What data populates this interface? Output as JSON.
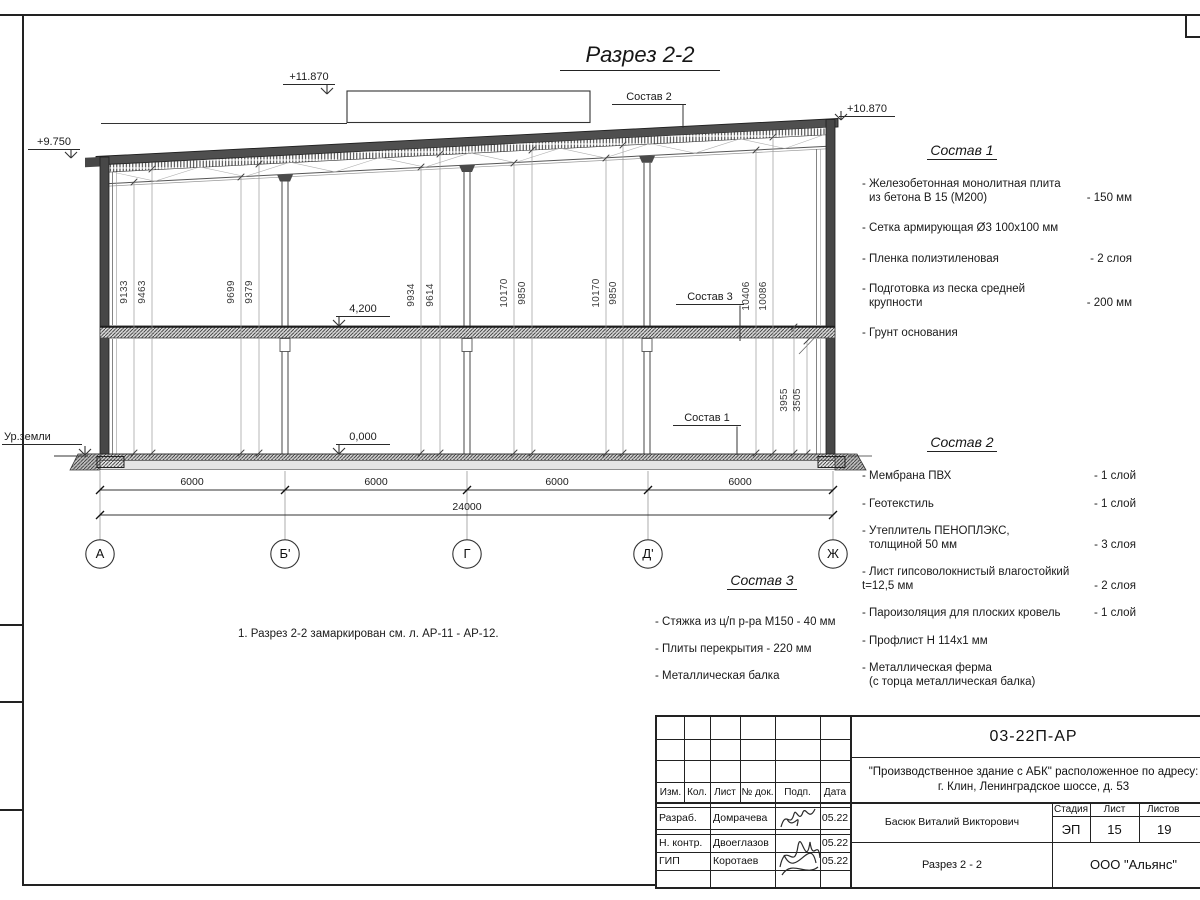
{
  "sheet": {
    "title": "Разрез 2-2",
    "note": "1. Разрез 2-2 замаркирован см. л. АР-11 - АР-12."
  },
  "elevations": {
    "roof_high": "+11.870",
    "roof_left": "+9.750",
    "roof_right": "+10.870",
    "floor2": "4,200",
    "floor1": "0,000",
    "ground": "Ур.земли"
  },
  "callouts": {
    "c1": "Состав 1",
    "c2": "Состав 2",
    "c3": "Состав 3"
  },
  "axes": [
    "А",
    "Б'",
    "Г",
    "Д'",
    "Ж"
  ],
  "dims": {
    "spans": [
      "6000",
      "6000",
      "6000",
      "6000"
    ],
    "total": "24000",
    "vertical": [
      "9133",
      "9463",
      "9699",
      "9379",
      "9934",
      "9614",
      "10170",
      "9850",
      "10170",
      "9850",
      "10406",
      "10086",
      "3955",
      "3505"
    ]
  },
  "compositions": {
    "c1": {
      "heading": "Состав 1",
      "lines": [
        {
          "t": "- Железобетонная  монолитная плита",
          "v": ""
        },
        {
          "t": "из бетона В 15 (М200)",
          "v": "- 150 мм"
        },
        {
          "t": "- Сетка армирующая Ø3 100x100 мм",
          "v": ""
        },
        {
          "t": "- Пленка полиэтиленовая",
          "v": "-  2 слоя"
        },
        {
          "t": "- Подготовка из песка средней",
          "v": ""
        },
        {
          "t": "крупности",
          "v": "- 200 мм"
        },
        {
          "t": "- Грунт основания",
          "v": ""
        }
      ]
    },
    "c2": {
      "heading": "Состав 2",
      "lines": [
        {
          "t": "- Мембрана ПВХ",
          "v": "- 1 слой"
        },
        {
          "t": "- Геотекстиль",
          "v": "- 1 слой"
        },
        {
          "t": "- Утеплитель ПЕНОПЛЭКС,",
          "v": ""
        },
        {
          "t": "толщиной 50 мм",
          "v": "- 3 слоя"
        },
        {
          "t": "- Лист гипсоволокнистый влагостойкий",
          "v": ""
        },
        {
          "t": "t=12,5 мм",
          "v": "- 2 слоя"
        },
        {
          "t": "- Пароизоляция для плоских кровель",
          "v": "- 1 слой"
        },
        {
          "t": "- Профлист Н 114х1 мм",
          "v": ""
        },
        {
          "t": "- Металлическая ферма",
          "v": ""
        },
        {
          "t": "(с торца металлическая балка)",
          "v": ""
        }
      ]
    },
    "c3": {
      "heading": "Состав 3",
      "lines": [
        {
          "t": "- Стяжка из ц/п р-ра М150 - 40 мм",
          "v": ""
        },
        {
          "t": "- Плиты перекрытия - 220 мм",
          "v": ""
        },
        {
          "t": "- Металлическая балка",
          "v": ""
        }
      ]
    }
  },
  "title_block": {
    "doc_number": "03-22П-АР",
    "project_line1": "\"Производственное здание с АБК\" расположенное по адресу:",
    "project_line2": "г. Клин, Ленинградское шоссе, д. 53",
    "cols": [
      "Изм.",
      "Кол.",
      "Лист",
      "№ док.",
      "Подп.",
      "Дата"
    ],
    "rows": [
      {
        "role": "Разраб.",
        "name": "Домрачева",
        "date": "05.22"
      },
      {
        "role": "Н. контр.",
        "name": "Двоеглазов",
        "date": "05.22"
      },
      {
        "role": "ГИП",
        "name": "Коротаев",
        "date": "05.22"
      }
    ],
    "approver": "Басюк Виталий Викторович",
    "stage_label": "Стадия",
    "sheet_label": "Лист",
    "sheets_label": "Листов",
    "stage": "ЭП",
    "sheet_no": "15",
    "sheets_total": "19",
    "drawing_title": "Разрез 2 - 2",
    "company": "ООО \"Альянс\""
  }
}
